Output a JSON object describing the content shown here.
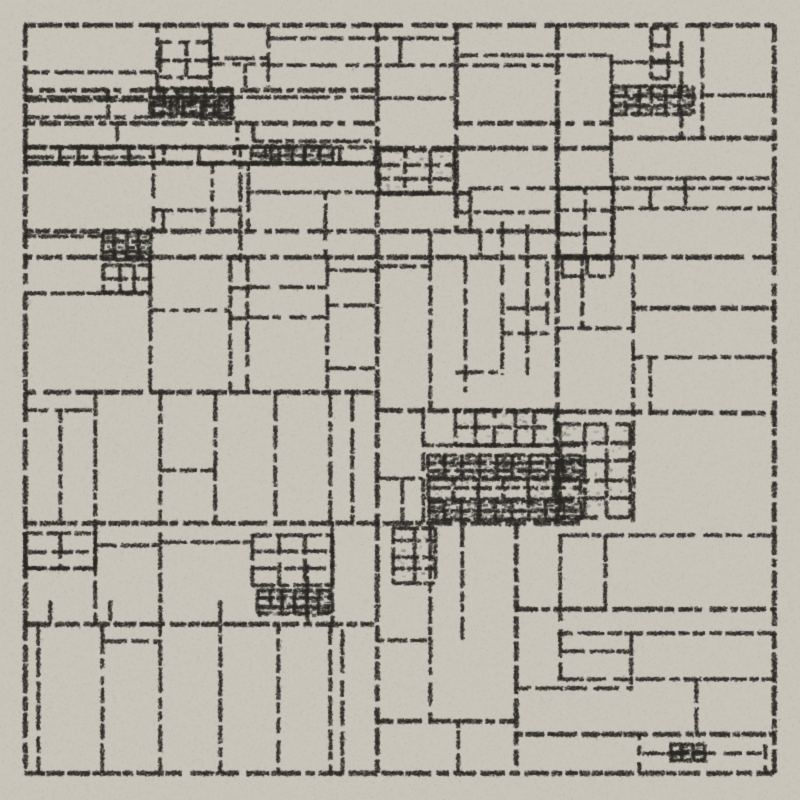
{
  "artwork": {
    "title": "Recursive rectangle subdivision drawing, charcoal grid on paper",
    "canvas": {
      "width": 800,
      "height": 800
    },
    "palette": {
      "background": "#c9c5bb",
      "ink": "#2b2925",
      "speck_light": "#ffffff"
    },
    "seed": 20240817,
    "frame": {
      "x": 25,
      "y": 25,
      "width": 749,
      "height": 748,
      "stroke_width": 3
    },
    "grain": {
      "dot_alpha_min": 0.35,
      "dot_alpha_max": 0.95,
      "pen_run_min": 6,
      "pen_run_max": 30,
      "gap_min": 1,
      "gap_max": 5,
      "dark_noise_dots": 70000,
      "light_noise_dots": 45000
    },
    "segments": [
      [
        25,
        72,
        157,
        72,
        2
      ],
      [
        157,
        25,
        157,
        90,
        2
      ],
      [
        25,
        90,
        375,
        90,
        3
      ],
      [
        25,
        97,
        375,
        97,
        2
      ],
      [
        25,
        100,
        150,
        100,
        1.5
      ],
      [
        108,
        90,
        108,
        117,
        1.5
      ],
      [
        25,
        117,
        153,
        117,
        2
      ],
      [
        200,
        118,
        237,
        118,
        1.5
      ],
      [
        25,
        123,
        375,
        123,
        3
      ],
      [
        117,
        123,
        117,
        147,
        2
      ],
      [
        25,
        147,
        253,
        147,
        3
      ],
      [
        253,
        141,
        377,
        141,
        2
      ],
      [
        25,
        157,
        155,
        157,
        1.5
      ],
      [
        78,
        147,
        78,
        163,
        1.5
      ],
      [
        25,
        163,
        375,
        163,
        3
      ],
      [
        237,
        123,
        237,
        141,
        1.5
      ],
      [
        253,
        123,
        253,
        141,
        1.5
      ],
      [
        268,
        38,
        456,
        38,
        2
      ],
      [
        210,
        58,
        268,
        58,
        2
      ],
      [
        210,
        64,
        268,
        64,
        1.5
      ],
      [
        245,
        64,
        245,
        87,
        1.5
      ],
      [
        210,
        25,
        210,
        87,
        2
      ],
      [
        268,
        25,
        268,
        87,
        2
      ],
      [
        268,
        65,
        558,
        65,
        1.5
      ],
      [
        400,
        38,
        400,
        65,
        2
      ],
      [
        377,
        98,
        456,
        98,
        2
      ],
      [
        456,
        25,
        456,
        232,
        2.5
      ],
      [
        460,
        55,
        611,
        55,
        1.5
      ],
      [
        611,
        55,
        611,
        178,
        2
      ],
      [
        611,
        62,
        681,
        62,
        1.5
      ],
      [
        681,
        42,
        681,
        138,
        2
      ],
      [
        702,
        25,
        702,
        138,
        2
      ],
      [
        702,
        95,
        775,
        95,
        2
      ],
      [
        456,
        123,
        611,
        123,
        3
      ],
      [
        611,
        138,
        775,
        138,
        3
      ],
      [
        377,
        148,
        611,
        148,
        3
      ],
      [
        612,
        178,
        775,
        178,
        2
      ],
      [
        470,
        188,
        775,
        188,
        2
      ],
      [
        613,
        178,
        613,
        255,
        2
      ],
      [
        650,
        188,
        650,
        208,
        2
      ],
      [
        685,
        178,
        685,
        208,
        2
      ],
      [
        614,
        208,
        775,
        208,
        2
      ],
      [
        470,
        188,
        470,
        232,
        2
      ],
      [
        456,
        212,
        556,
        212,
        1.5
      ],
      [
        377,
        193,
        470,
        193,
        3
      ],
      [
        153,
        148,
        153,
        232,
        2
      ],
      [
        153,
        210,
        240,
        210,
        2
      ],
      [
        212,
        163,
        212,
        230,
        2
      ],
      [
        163,
        210,
        163,
        230,
        1.5
      ],
      [
        240,
        148,
        240,
        262,
        2
      ],
      [
        248,
        163,
        248,
        232,
        1.5
      ],
      [
        247,
        192,
        375,
        192,
        2
      ],
      [
        325,
        192,
        325,
        257,
        2
      ],
      [
        25,
        231,
        558,
        231,
        3
      ],
      [
        25,
        236,
        105,
        236,
        1.5
      ],
      [
        25,
        257,
        775,
        257,
        3
      ],
      [
        150,
        258,
        150,
        392,
        2
      ],
      [
        25,
        293,
        150,
        293,
        2
      ],
      [
        230,
        258,
        230,
        392,
        2
      ],
      [
        150,
        310,
        230,
        310,
        2
      ],
      [
        247,
        258,
        247,
        392,
        2
      ],
      [
        230,
        288,
        247,
        288,
        1.5
      ],
      [
        230,
        318,
        247,
        318,
        1.5
      ],
      [
        247,
        287,
        327,
        287,
        2
      ],
      [
        247,
        317,
        327,
        317,
        2
      ],
      [
        327,
        258,
        327,
        392,
        2
      ],
      [
        327,
        270,
        375,
        270,
        1.5
      ],
      [
        327,
        305,
        375,
        305,
        2
      ],
      [
        327,
        368,
        375,
        368,
        1.5
      ],
      [
        25,
        392,
        377,
        392,
        3
      ],
      [
        377,
        25,
        377,
        773,
        2.5
      ],
      [
        377,
        266,
        430,
        266,
        2
      ],
      [
        430,
        232,
        430,
        410,
        2
      ],
      [
        465,
        257,
        465,
        392,
        2
      ],
      [
        502,
        222,
        502,
        375,
        2
      ],
      [
        527,
        225,
        527,
        375,
        2
      ],
      [
        547,
        262,
        547,
        335,
        1.5
      ],
      [
        507,
        308,
        547,
        308,
        1.5
      ],
      [
        502,
        333,
        547,
        333,
        1.5
      ],
      [
        456,
        372,
        502,
        372,
        2
      ],
      [
        480,
        232,
        480,
        257,
        1.5
      ],
      [
        557,
        25,
        557,
        523,
        2.5
      ],
      [
        582,
        257,
        582,
        328,
        2
      ],
      [
        558,
        328,
        633,
        328,
        2
      ],
      [
        633,
        308,
        775,
        308,
        3
      ],
      [
        633,
        257,
        633,
        523,
        2
      ],
      [
        633,
        357,
        775,
        357,
        2
      ],
      [
        650,
        358,
        650,
        415,
        2
      ],
      [
        377,
        410,
        775,
        413,
        3
      ],
      [
        60,
        410,
        60,
        523,
        2
      ],
      [
        25,
        410,
        95,
        410,
        2
      ],
      [
        95,
        392,
        95,
        523,
        2
      ],
      [
        160,
        392,
        160,
        523,
        2
      ],
      [
        215,
        392,
        215,
        523,
        2
      ],
      [
        160,
        470,
        215,
        470,
        1.5
      ],
      [
        275,
        392,
        275,
        523,
        2
      ],
      [
        330,
        392,
        330,
        523,
        2
      ],
      [
        352,
        392,
        352,
        523,
        1.5
      ],
      [
        423,
        408,
        423,
        523,
        2
      ],
      [
        423,
        445,
        580,
        445,
        2
      ],
      [
        377,
        478,
        423,
        478,
        2
      ],
      [
        402,
        478,
        402,
        523,
        1.5
      ],
      [
        25,
        523,
        580,
        523,
        3
      ],
      [
        560,
        535,
        775,
        535,
        2
      ],
      [
        95,
        524,
        95,
        624,
        2
      ],
      [
        160,
        533,
        160,
        624,
        2
      ],
      [
        25,
        568,
        95,
        568,
        2
      ],
      [
        95,
        545,
        160,
        545,
        1.5
      ],
      [
        160,
        542,
        252,
        542,
        1.5
      ],
      [
        332,
        524,
        332,
        624,
        2
      ],
      [
        50,
        601,
        50,
        624,
        1.5
      ],
      [
        110,
        601,
        110,
        624,
        1.5
      ],
      [
        220,
        601,
        220,
        624,
        1.5
      ],
      [
        307,
        565,
        307,
        624,
        1.5
      ],
      [
        25,
        624,
        375,
        624,
        3
      ],
      [
        38,
        625,
        38,
        773,
        2
      ],
      [
        102,
        625,
        102,
        773,
        2
      ],
      [
        160,
        625,
        160,
        773,
        2
      ],
      [
        220,
        625,
        220,
        773,
        2
      ],
      [
        278,
        625,
        278,
        773,
        2
      ],
      [
        330,
        625,
        330,
        773,
        2
      ],
      [
        342,
        630,
        342,
        773,
        1.5
      ],
      [
        103,
        641,
        160,
        641,
        1.5
      ],
      [
        430,
        524,
        430,
        721,
        2
      ],
      [
        462,
        524,
        462,
        640,
        1.5
      ],
      [
        377,
        640,
        430,
        640,
        1.5
      ],
      [
        377,
        721,
        516,
        721,
        3
      ],
      [
        458,
        721,
        458,
        773,
        2
      ],
      [
        516,
        523,
        516,
        773,
        2.5
      ],
      [
        560,
        535,
        560,
        679,
        2
      ],
      [
        605,
        535,
        605,
        609,
        2
      ],
      [
        516,
        609,
        775,
        609,
        3
      ],
      [
        558,
        633,
        775,
        633,
        2
      ],
      [
        561,
        651,
        630,
        651,
        2
      ],
      [
        631,
        633,
        631,
        688,
        2
      ],
      [
        558,
        679,
        775,
        679,
        2
      ],
      [
        516,
        688,
        633,
        688,
        2
      ],
      [
        696,
        679,
        696,
        734,
        1.5
      ],
      [
        516,
        734,
        775,
        734,
        3
      ],
      [
        639,
        734,
        639,
        773,
        2
      ],
      [
        765,
        745,
        765,
        773,
        2
      ],
      [
        643,
        753,
        762,
        753,
        1.5
      ]
    ],
    "clusters": [
      [
        150,
        88,
        82,
        26,
        "heavy",
        3,
        6
      ],
      [
        153,
        101,
        78,
        15,
        "light",
        1,
        5
      ],
      [
        25,
        147,
        350,
        16,
        "light",
        1,
        10
      ],
      [
        252,
        147,
        80,
        16,
        "heavy",
        2,
        6
      ],
      [
        103,
        233,
        47,
        27,
        "heavy",
        3,
        4
      ],
      [
        103,
        265,
        47,
        27,
        "light",
        2,
        3
      ],
      [
        160,
        42,
        50,
        35,
        "light",
        2,
        2
      ],
      [
        612,
        86,
        80,
        28,
        "heavy",
        3,
        6
      ],
      [
        651,
        28,
        17,
        50,
        "light",
        3,
        1
      ],
      [
        558,
        188,
        54,
        68,
        "light",
        3,
        2
      ],
      [
        562,
        258,
        50,
        18,
        "light",
        1,
        2
      ],
      [
        379,
        150,
        75,
        43,
        "medium",
        3,
        3
      ],
      [
        455,
        410,
        100,
        35,
        "medium",
        2,
        5
      ],
      [
        428,
        455,
        152,
        22,
        "heavy",
        3,
        9
      ],
      [
        428,
        479,
        152,
        20,
        "medium",
        2,
        6
      ],
      [
        428,
        501,
        152,
        19,
        "heavy",
        2,
        9
      ],
      [
        560,
        424,
        70,
        93,
        "medium",
        5,
        3
      ],
      [
        393,
        528,
        42,
        55,
        "medium",
        4,
        2
      ],
      [
        252,
        535,
        80,
        50,
        "light",
        3,
        3
      ],
      [
        258,
        590,
        72,
        24,
        "heavy",
        3,
        6
      ],
      [
        25,
        533,
        70,
        35,
        "light",
        2,
        2
      ],
      [
        670,
        745,
        34,
        15,
        "heavy",
        2,
        3
      ]
    ]
  }
}
